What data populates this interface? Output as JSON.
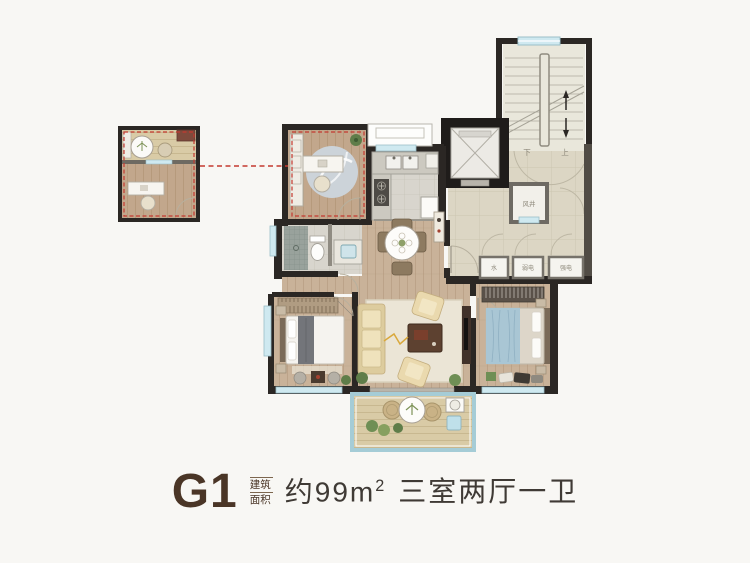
{
  "caption": {
    "unit_code": "G1",
    "area_label_line1": "建筑",
    "area_label_line2": "面积",
    "area_value": "约99m",
    "area_value_sup": "2",
    "room_config": "三室两厅一卫"
  },
  "plan": {
    "labels": {
      "wind_shaft": "风井",
      "water_meter": "水",
      "weak_electric": "弱电",
      "strong_electric": "强电",
      "stair_down": "下",
      "stair_up": "上"
    },
    "colors": {
      "wall": "#2b2724",
      "window": "#cfe9f0",
      "highlight_dashed": "#c4392f",
      "wood_floor": "#c9b299",
      "corridor_floor": "#dcd6c4",
      "caption_brown": "#4a3526",
      "caption_text": "#3f3a35"
    }
  }
}
